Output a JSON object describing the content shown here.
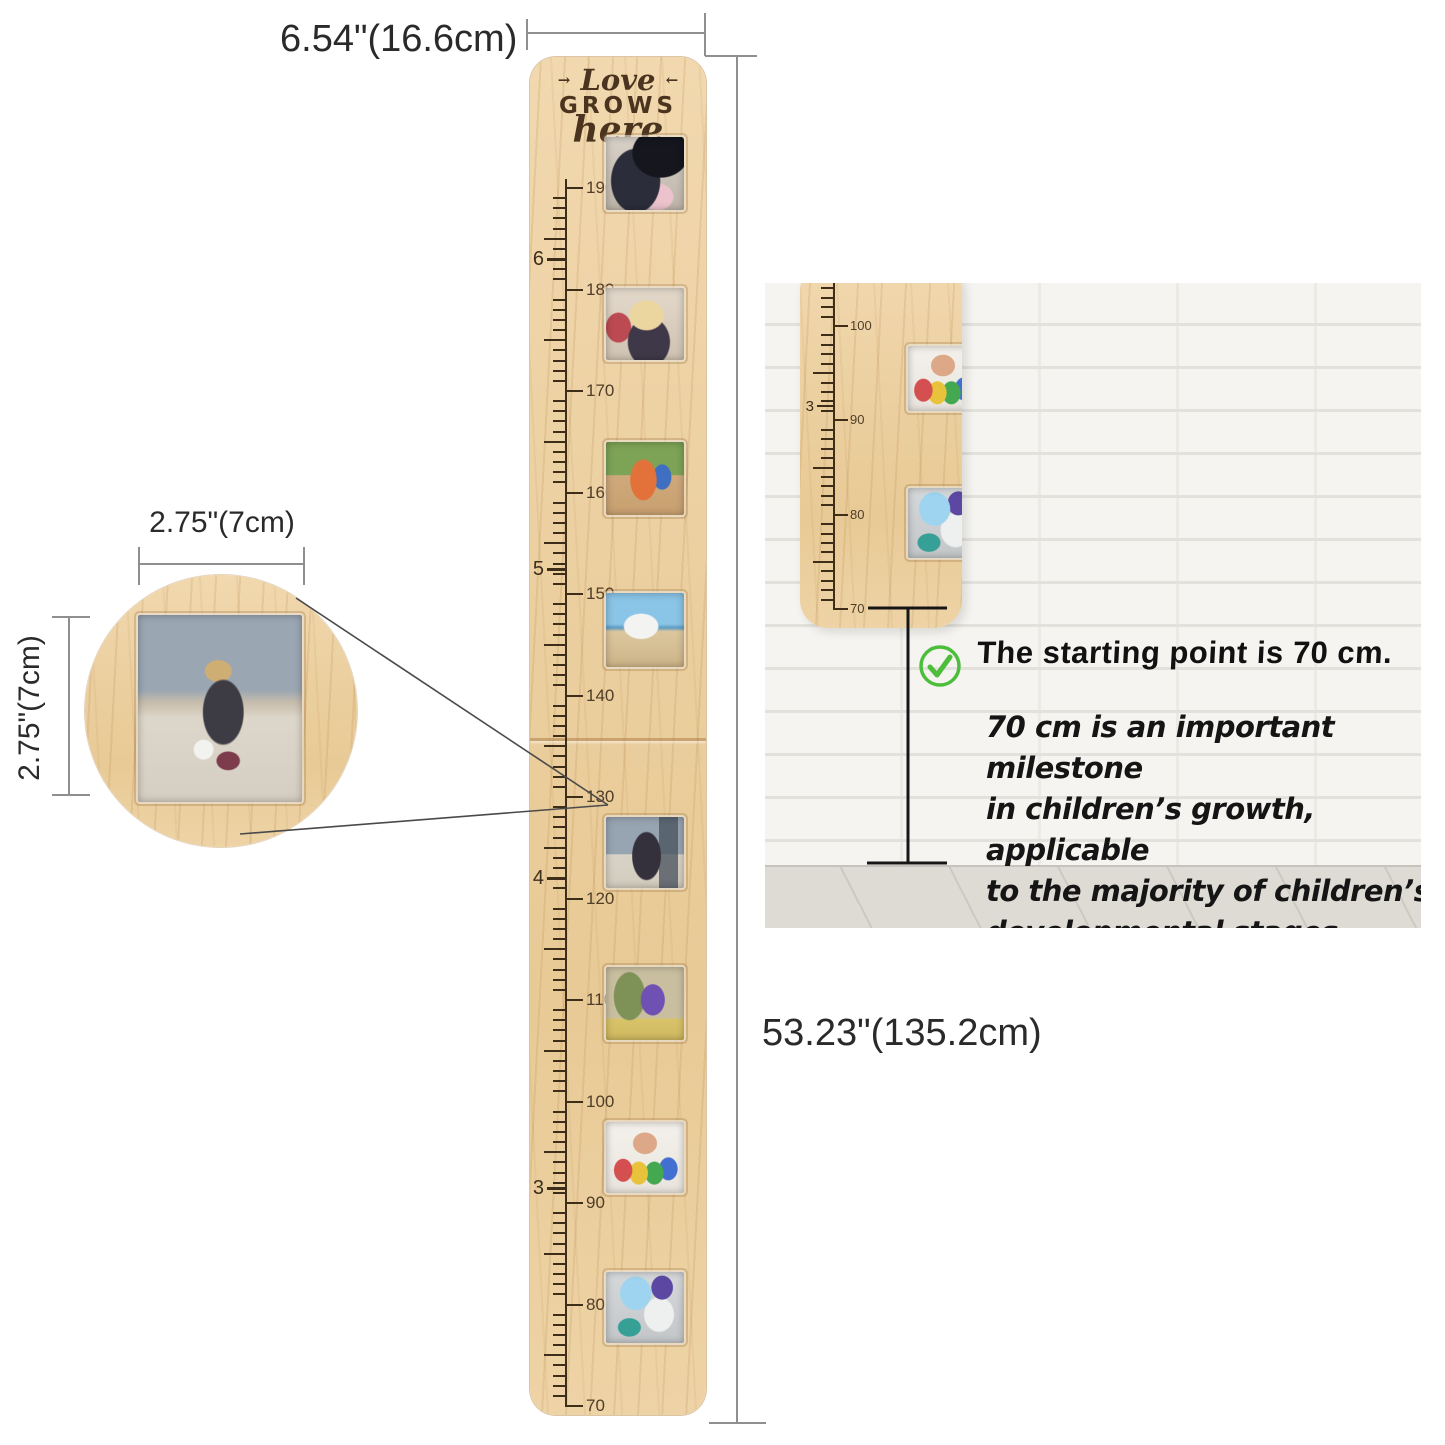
{
  "labels": {
    "board_width": "6.54\"(16.6cm)",
    "board_height": "53.23\"(135.2cm)",
    "frame_width": "2.75\"(7cm)",
    "frame_height": "2.75\"(7cm)"
  },
  "board": {
    "engraving": {
      "deco_left": "→",
      "word1": "Love",
      "word2": "GROWS",
      "word3": "here",
      "deco_right": "←"
    }
  },
  "rulers": {
    "main": {
      "unit": "cm",
      "min": 70,
      "max": 190,
      "cm_label_step": 10,
      "feet": [
        {
          "text": "6",
          "cm": 182.9
        },
        {
          "text": "5",
          "cm": 152.4
        },
        {
          "text": "4",
          "cm": 121.9
        },
        {
          "text": "3",
          "cm": 91.4
        }
      ]
    },
    "inset": {
      "unit": "cm",
      "min": 70,
      "max": 106,
      "cm_label_step": 10,
      "feet": [
        {
          "text": "3",
          "cm": 91.4
        }
      ]
    }
  },
  "inset": {
    "headline": "The starting point is 70 cm.",
    "paragraph_lines": [
      "70 cm is an important milestone",
      "in children’s growth, applicable",
      "to the majority of children’s",
      "developmental stages."
    ]
  },
  "colors": {
    "check_green": "#4cbe3c",
    "wood_light": "#eed3a6",
    "dimension_line": "#8f8f8f",
    "ruler_mark": "#3e2d18"
  }
}
